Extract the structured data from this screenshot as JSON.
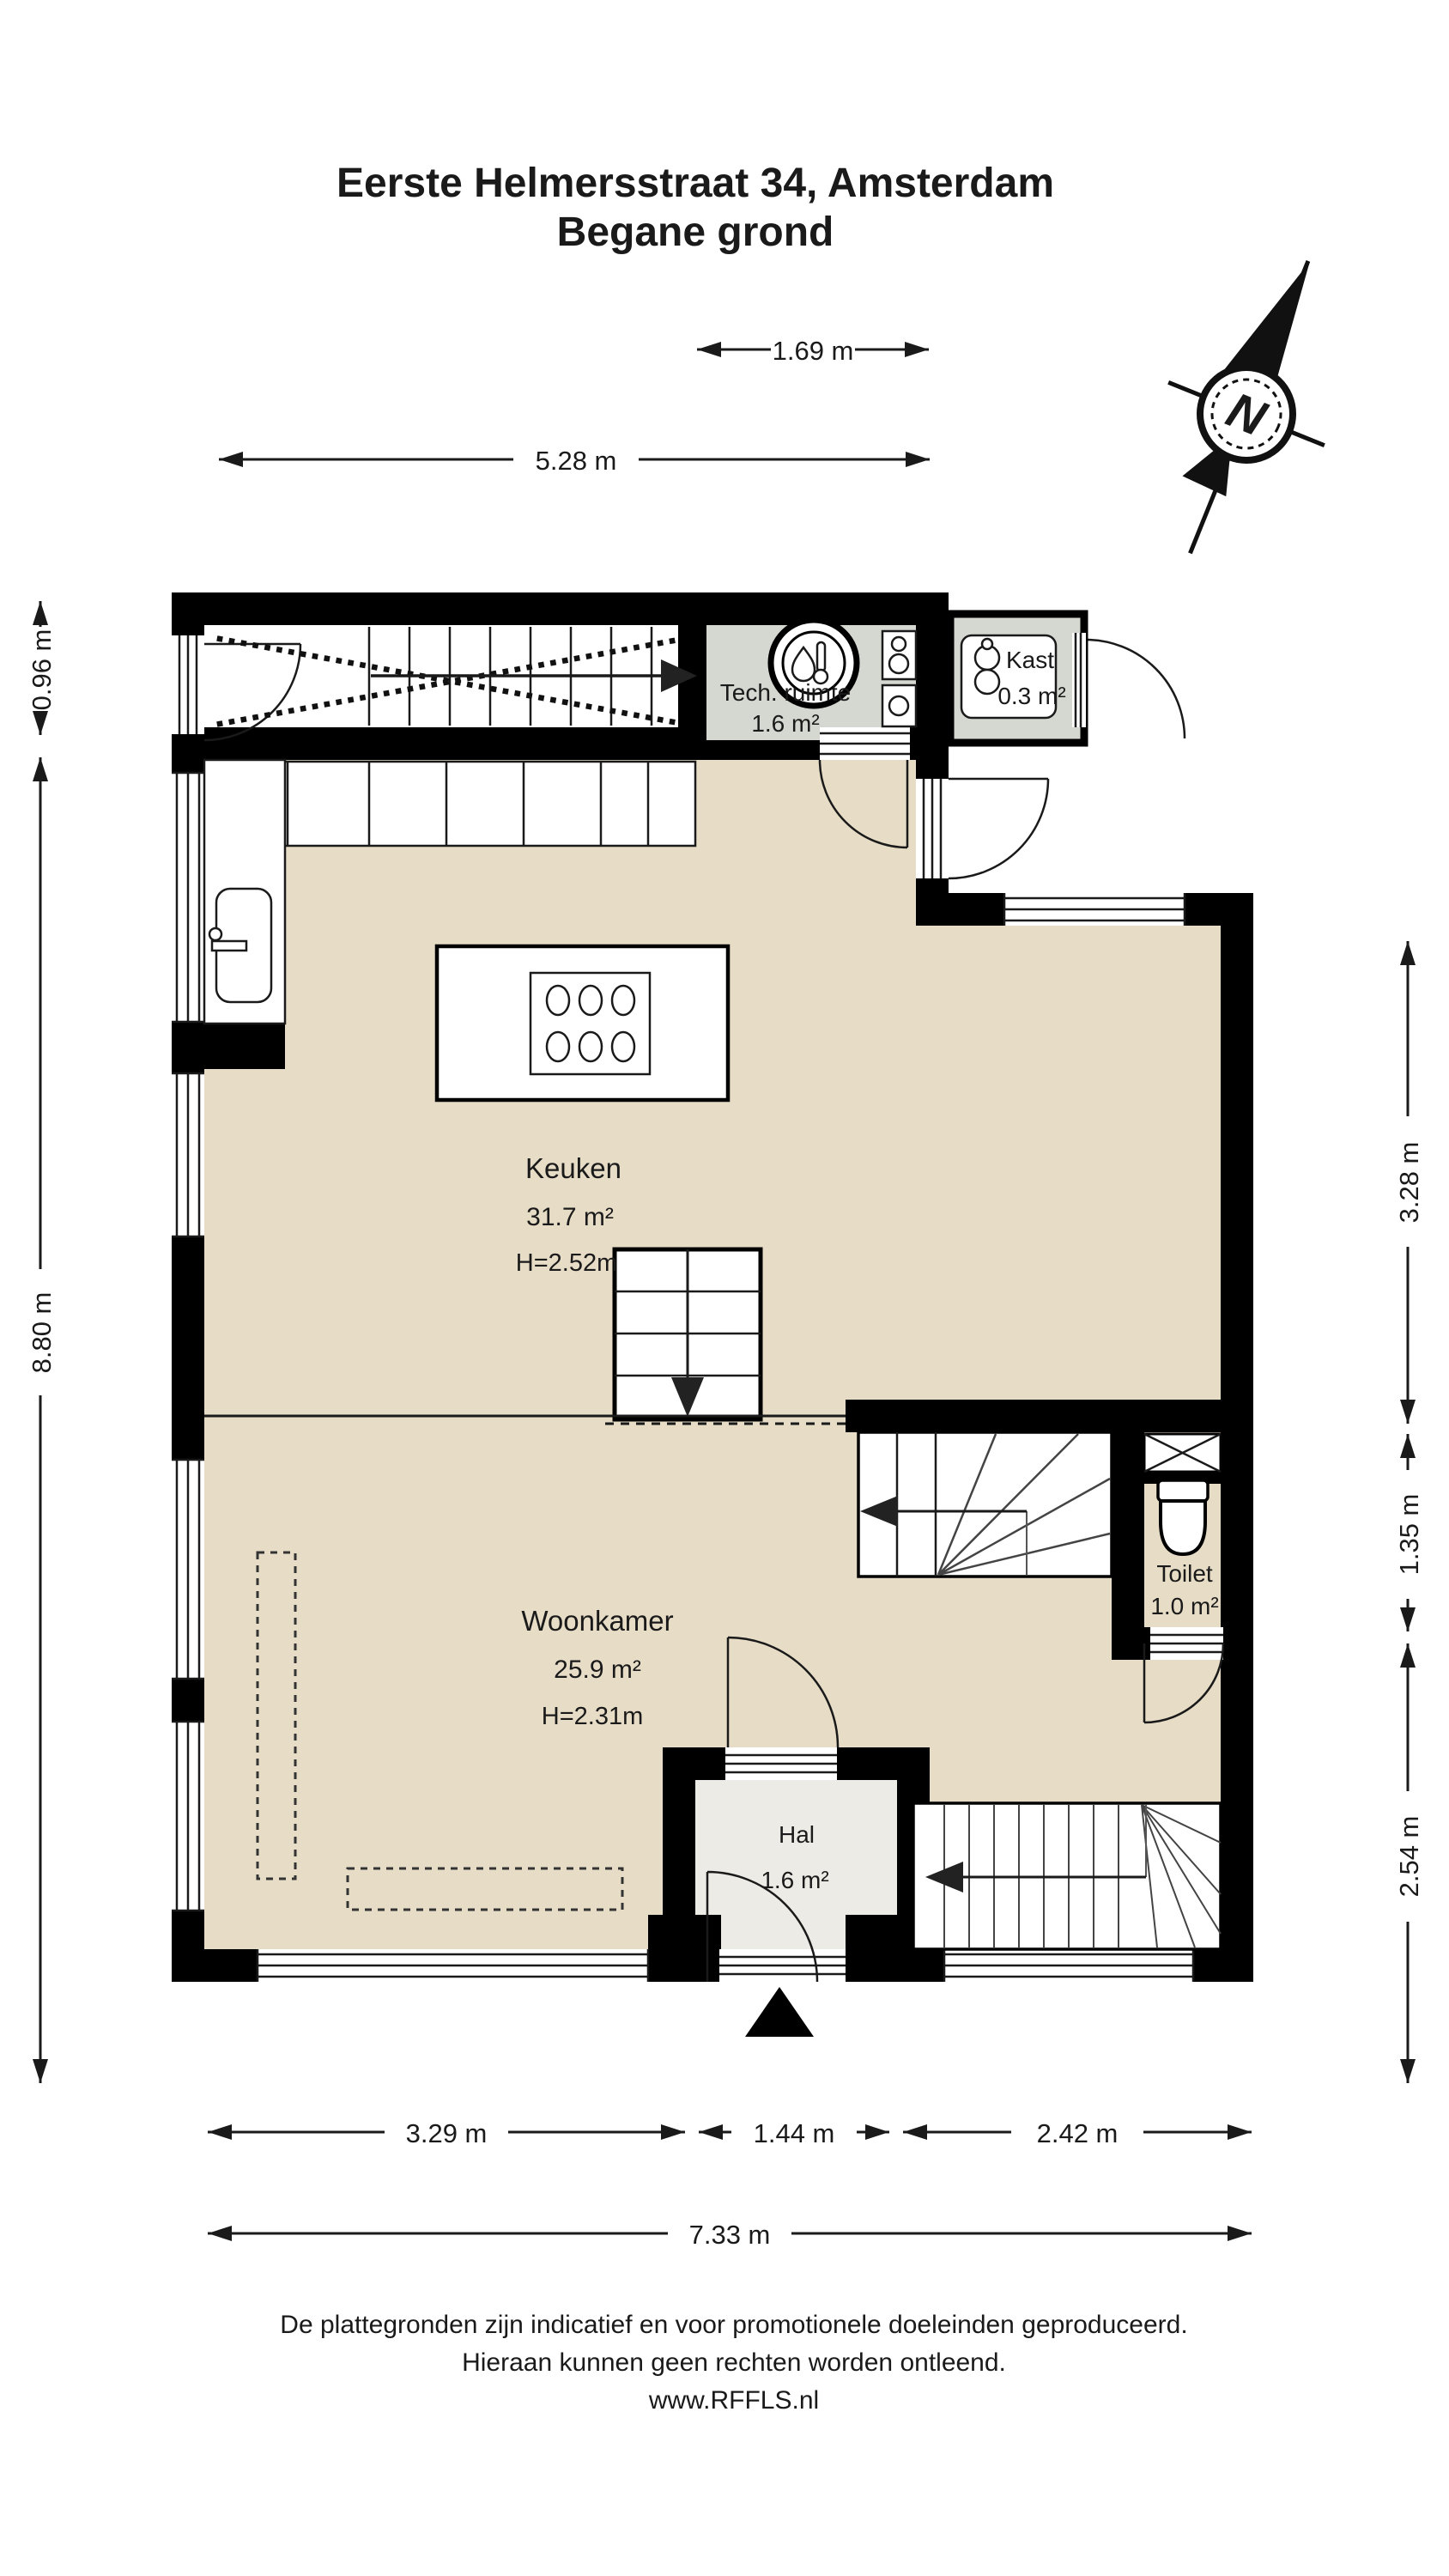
{
  "title": {
    "line1": "Eerste Helmersstraat 34, Amsterdam",
    "line2": "Begane grond"
  },
  "compass": {
    "label": "N"
  },
  "rooms": {
    "tech_ruimte": {
      "name": "Tech. ruimte",
      "area": "1.6 m²"
    },
    "kast": {
      "name": "Kast",
      "area": "0.3 m²"
    },
    "keuken": {
      "name": "Keuken",
      "area": "31.7 m²",
      "ceiling_height": "H=2.52m"
    },
    "woonkamer": {
      "name": "Woonkamer",
      "area": "25.9 m²",
      "ceiling_height": "H=2.31m"
    },
    "toilet": {
      "name": "Toilet",
      "area": "1.0 m²"
    },
    "hal": {
      "name": "Hal",
      "area": "1.6 m²"
    }
  },
  "dimensions": {
    "top_inner": "1.69 m",
    "top_outer": "5.28 m",
    "left_upper": "0.96 m",
    "left_main": "8.80 m",
    "right_upper": "3.28 m",
    "right_middle": "1.35 m",
    "right_lower": "2.54 m",
    "bottom_left": "3.29 m",
    "bottom_middle": "1.44 m",
    "bottom_right": "2.42 m",
    "bottom_total": "7.33 m"
  },
  "footer": {
    "line1": "De plattegronden zijn indicatief en voor promotionele doeleinden geproduceerd.",
    "line2": "Hieraan kunnen geen rechten worden ontleend.",
    "line3": "www.RFFLS.nl"
  },
  "colors": {
    "wall": "#000000",
    "floor": "#e7dcc6",
    "utility_floor": "#d5d7d1",
    "hall_floor": "#ecebe5",
    "line": "#1a1a1a"
  }
}
